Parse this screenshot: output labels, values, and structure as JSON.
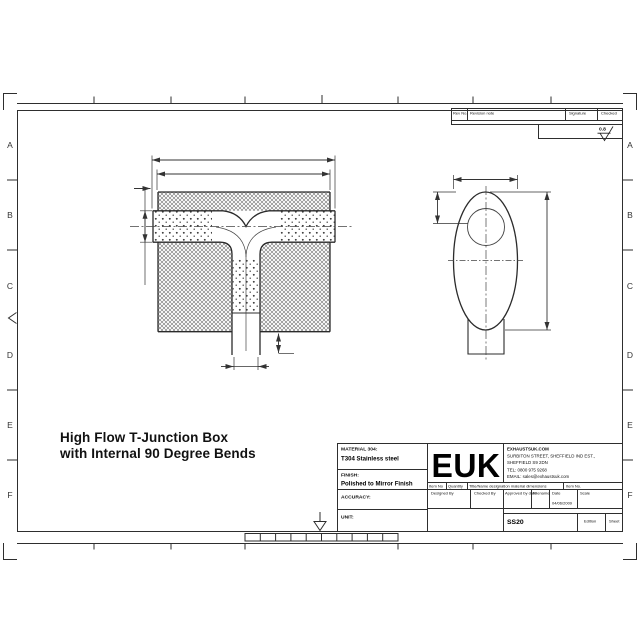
{
  "frame": {
    "row_labels": [
      "A",
      "B",
      "C",
      "D",
      "E",
      "F"
    ]
  },
  "drawing": {
    "title_line1": "High Flow T-Junction Box",
    "title_line2": "with Internal 90 Degree Bends"
  },
  "revision_table": {
    "headers": [
      "Rev No.",
      "Revision note",
      "Signature",
      "Checked"
    ]
  },
  "surface_finish": {
    "value": "0.8"
  },
  "title_block": {
    "material_label": "MATERIAL 304:",
    "material_value": "T304 Stainless steel",
    "finish_label": "FINISH:",
    "finish_value": "Polished to Mirror Finish",
    "accuracy_label": "ACCURACY:",
    "unit_label": "UNIT:",
    "logo_text": "EUK",
    "company": {
      "website": "EXHAUSTSUK.COM",
      "address_line1": "SURBITON STREET, SHEFFIELD IND EST.,",
      "address_line2": "SHEFFIELD S9 2DN",
      "tel": "TEL: 0800 975 9268",
      "email": "EMAIL: sales@exhaustsuk.com"
    },
    "item_row_headers": [
      "Item No",
      "Quantity",
      "Title/Name designation material dimensions",
      "Item No."
    ],
    "approval_row_headers": [
      "Designed By",
      "Checked By",
      "Approved by date",
      "Filename",
      "Date",
      "Scale"
    ],
    "date_value": "04/06/2009",
    "drawing_number": "SS20",
    "edition_label": "Edition",
    "sheet_label": "Sheet"
  }
}
